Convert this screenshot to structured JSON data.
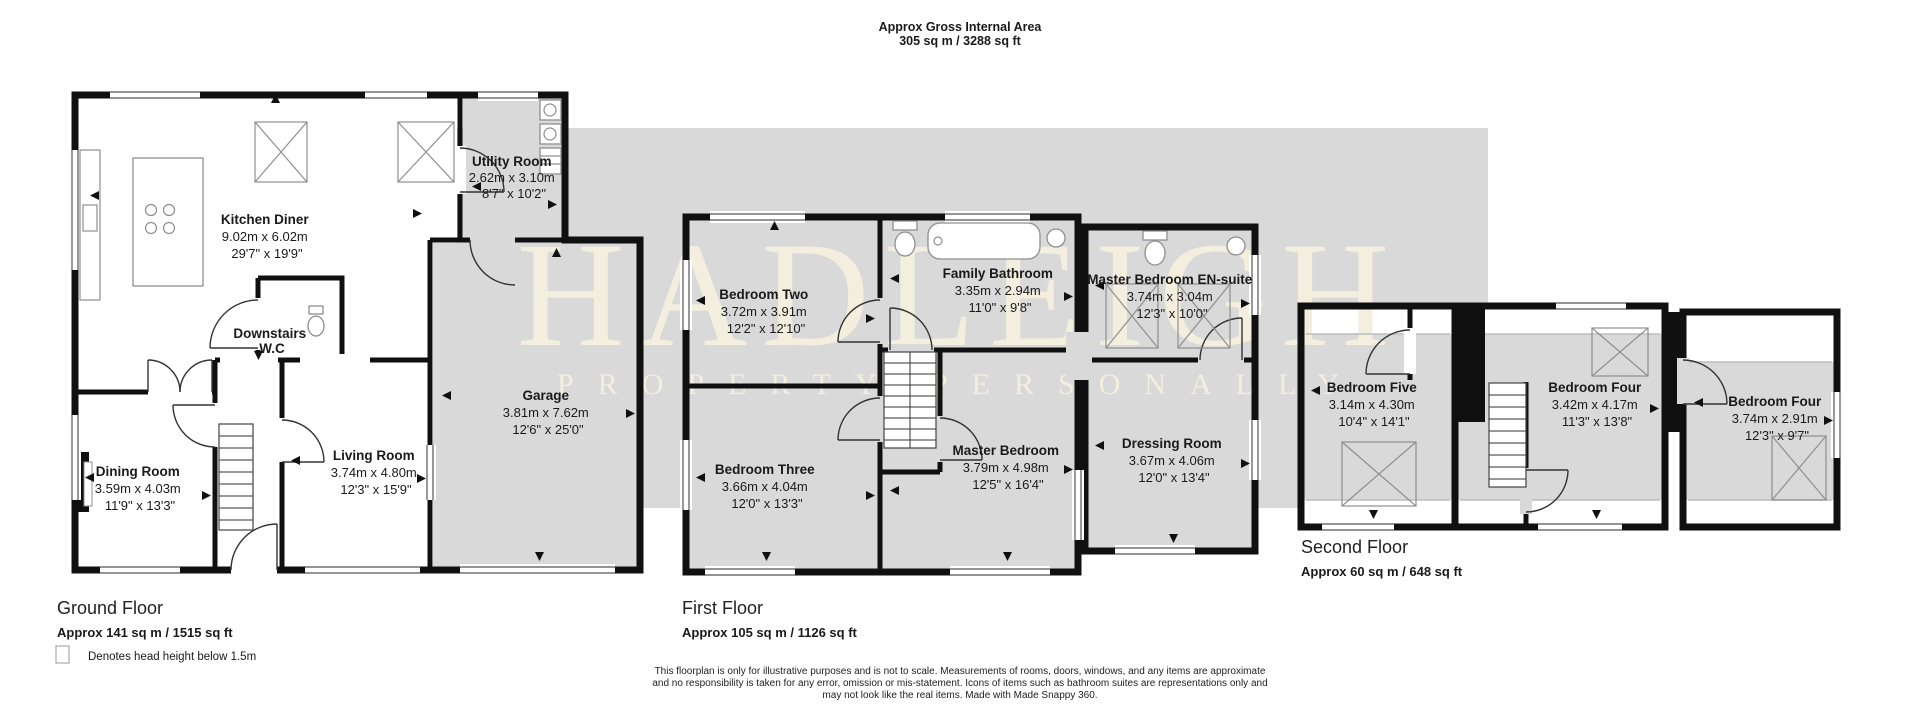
{
  "header": {
    "title": "Approx Gross Internal Area",
    "subtitle": "305 sq m / 3288 sq ft"
  },
  "watermark": {
    "line1": "HADLEIGH",
    "line2": "PROPERTY PERSONALLY",
    "band_color": "#d9d9d9",
    "text_color": "#f3eedd"
  },
  "floors": [
    {
      "name": "Ground Floor",
      "area": "Approx 141 sq m / 1515 sq ft",
      "rooms": [
        {
          "name": "Kitchen Diner",
          "metric": "9.02m x 6.02m",
          "imperial": "29'7\" x 19'9\""
        },
        {
          "name": "Utility Room",
          "metric": "2.62m x 3.10m",
          "imperial": "8'7\" x 10'2\""
        },
        {
          "name": "Downstairs W.C",
          "name_line1": "Downstairs",
          "name_line2": "W.C"
        },
        {
          "name": "Garage",
          "metric": "3.81m x 7.62m",
          "imperial": "12'6\" x 25'0\""
        },
        {
          "name": "Dining Room",
          "metric": "3.59m x 4.03m",
          "imperial": "11'9\" x 13'3\""
        },
        {
          "name": "Living Room",
          "metric": "3.74m x 4.80m",
          "imperial": "12'3\" x 15'9\""
        }
      ]
    },
    {
      "name": "First Floor",
      "area": "Approx 105 sq m / 1126 sq ft",
      "rooms": [
        {
          "name": "Bedroom Two",
          "metric": "3.72m x 3.91m",
          "imperial": "12'2\" x 12'10\""
        },
        {
          "name": "Family Bathroom",
          "metric": "3.35m x 2.94m",
          "imperial": "11'0\" x 9'8\""
        },
        {
          "name": "Master Bedroom EN-suite",
          "metric": "3.74m x 3.04m",
          "imperial": "12'3\" x 10'0\""
        },
        {
          "name": "Bedroom Three",
          "metric": "3.66m x 4.04m",
          "imperial": "12'0\" x 13'3\""
        },
        {
          "name": "Master Bedroom",
          "metric": "3.79m x 4.98m",
          "imperial": "12'5\" x 16'4\""
        },
        {
          "name": "Dressing Room",
          "metric": "3.67m x 4.06m",
          "imperial": "12'0\" x 13'4\""
        }
      ]
    },
    {
      "name": "Second Floor",
      "area": "Approx 60 sq m / 648 sq ft",
      "rooms": [
        {
          "name": "Bedroom Five",
          "metric": "3.14m x 4.30m",
          "imperial": "10'4\" x 14'1\""
        },
        {
          "name": "Bedroom Four",
          "metric": "3.42m x 4.17m",
          "imperial": "11'3\" x 13'8\""
        },
        {
          "name": "Bedroom Four",
          "metric": "3.74m x 2.91m",
          "imperial": "12'3\" x 9'7\""
        }
      ]
    }
  ],
  "legend": {
    "text": "Denotes head height below 1.5m"
  },
  "disclaimer": {
    "line1": "This floorplan is only for illustrative purposes and is not to scale. Measurements of rooms, doors, windows, and any items are approximate",
    "line2": "and no responsibility is taken for any error, omission or mis-statement. Icons of items such as bathroom suites are representations only and",
    "line3": "may not look like the real items. Made with Made Snappy 360."
  },
  "colors": {
    "wall": "#101010",
    "room_gray": "#d9d9d9",
    "background": "#ffffff"
  }
}
